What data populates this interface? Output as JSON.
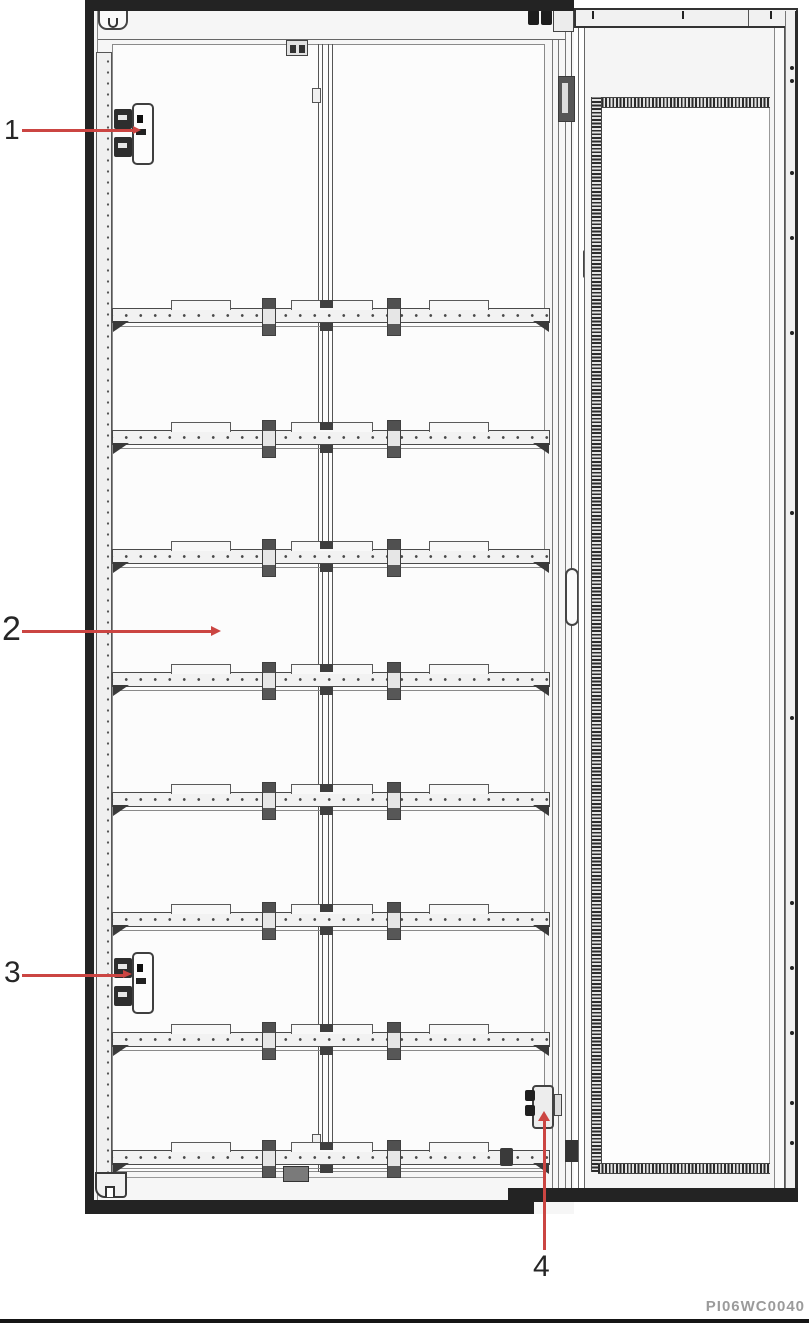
{
  "figure": {
    "description": "Cabinet interior parts-location line drawing",
    "part_code": "PI06WC0040",
    "callouts": {
      "c1": "1",
      "c2": "2",
      "c3": "3",
      "c4": "4"
    },
    "colors": {
      "leader_red": "#cb4542",
      "line_dark": "#3d3d3d",
      "frame_black": "#232323",
      "part_code_gray": "#9b9b9b"
    }
  }
}
